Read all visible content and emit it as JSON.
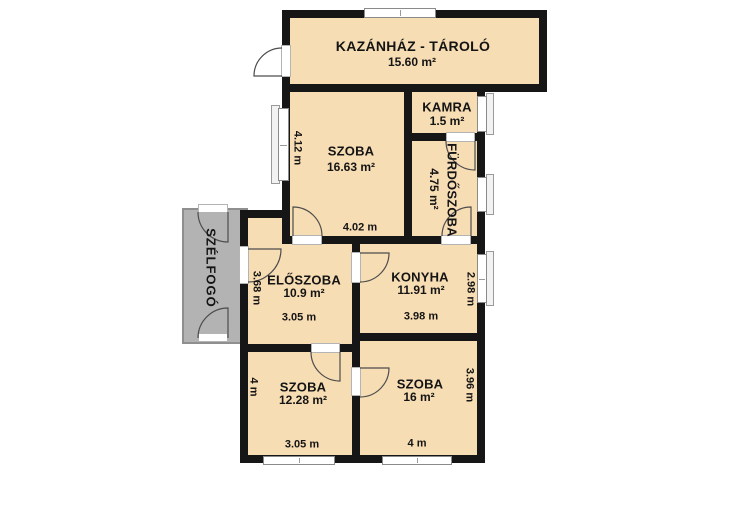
{
  "plan": {
    "type": "floor-plan",
    "language": "hu"
  },
  "colors": {
    "background": "#FFFFFF",
    "room_fill": "#F7DDB4",
    "porch_fill": "#B3B3B3",
    "wall": "#161616",
    "text": "#141414",
    "window_frame": "#8A8A8A",
    "door_arc": "#4D4D4D"
  },
  "rooms": {
    "kazanhaz": {
      "name": "KAZÁNHÁZ - TÁROLÓ",
      "area": "15.60 m²"
    },
    "kamra": {
      "name": "KAMRA",
      "area": "1.5 m²"
    },
    "szoba_nagy": {
      "name": "SZOBA",
      "area": "16.63 m²",
      "dim_side": "4.12 m",
      "dim_bottom": "4.02 m"
    },
    "furdoszoba": {
      "name": "FÜRDŐSZOBA",
      "area": "4.75 m²"
    },
    "eloszoba": {
      "name": "ELŐSZOBA",
      "area": "10.9 m²",
      "dim_side": "3.68 m",
      "dim_bottom": "3.05 m"
    },
    "konyha": {
      "name": "KONYHA",
      "area": "11.91 m²",
      "dim_side": "2.98 m",
      "dim_bottom": "3.98 m"
    },
    "szoba_bal_also": {
      "name": "SZOBA",
      "area": "12.28 m²",
      "dim_side": "4 m",
      "dim_bottom": "3.05 m"
    },
    "szoba_jobb_also": {
      "name": "SZOBA",
      "area": "16 m²",
      "dim_side": "3.96 m",
      "dim_bottom": "4 m"
    },
    "szelfogo": {
      "name": "SZÉLFOGÓ"
    }
  }
}
